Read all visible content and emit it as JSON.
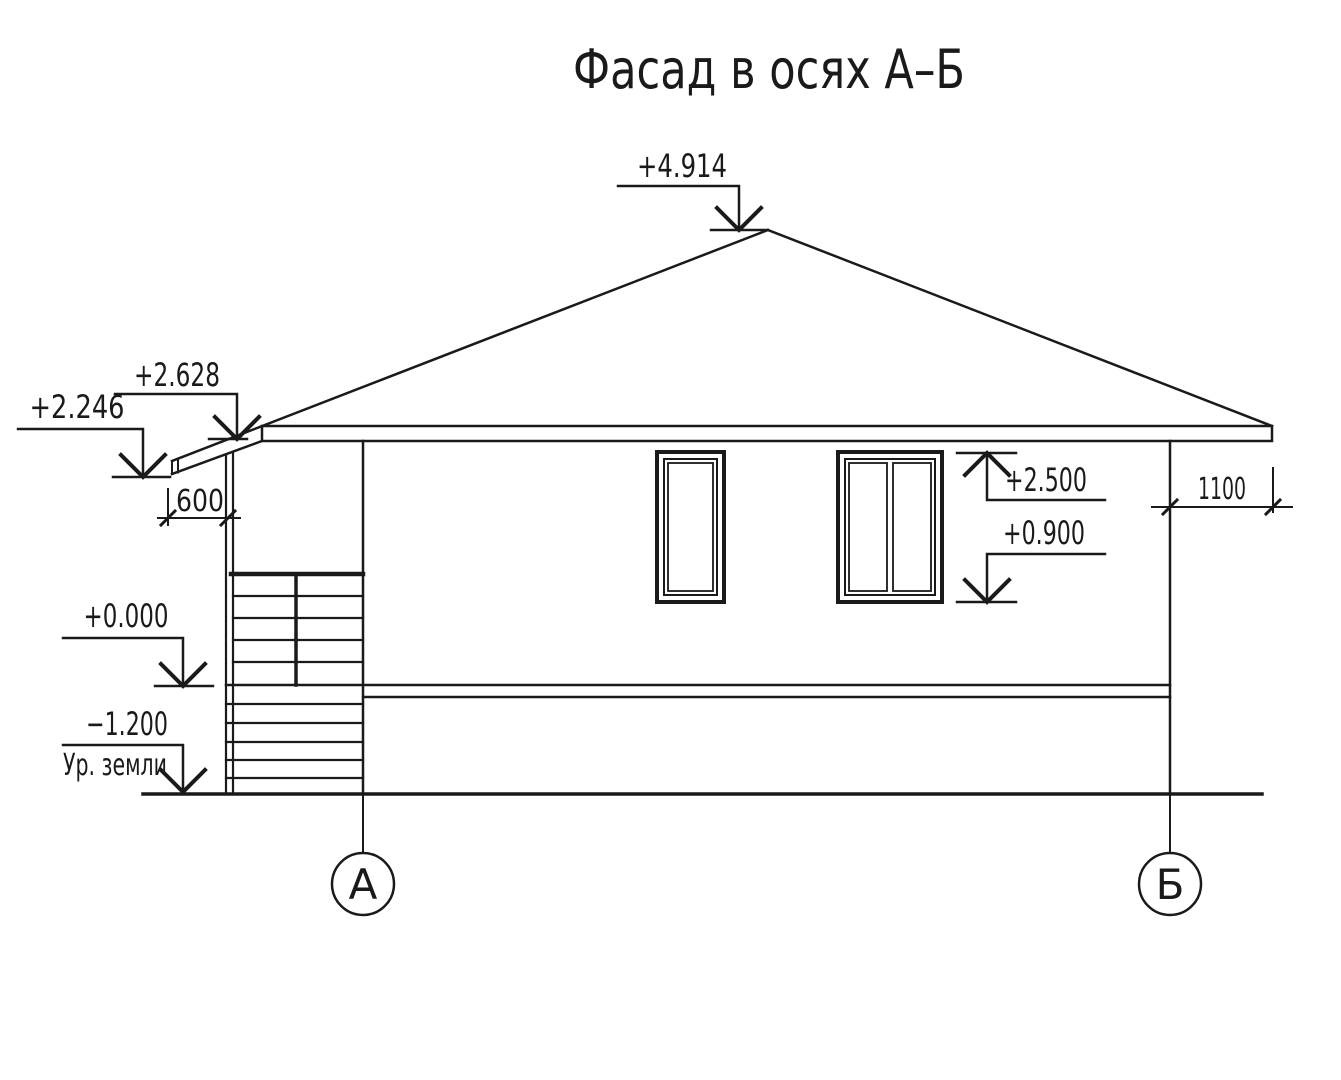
{
  "title": "Фасад в осях А–Б",
  "colors": {
    "line": "#1a1a1a",
    "glass": "#d9f6f8",
    "background": "#ffffff"
  },
  "elevation_marks": {
    "peak": "+4.914",
    "eave_top": "+2.628",
    "canopy_tip": "+2.246",
    "window_head": "+2.500",
    "window_sill": "+0.900",
    "floor": "+0.000",
    "ground": "−1.200",
    "ground_label": "Ур. земли"
  },
  "dimensions": {
    "canopy_overhang": "600",
    "wall_to_eave": "1100"
  },
  "axes": {
    "left": "А",
    "right": "Б"
  }
}
